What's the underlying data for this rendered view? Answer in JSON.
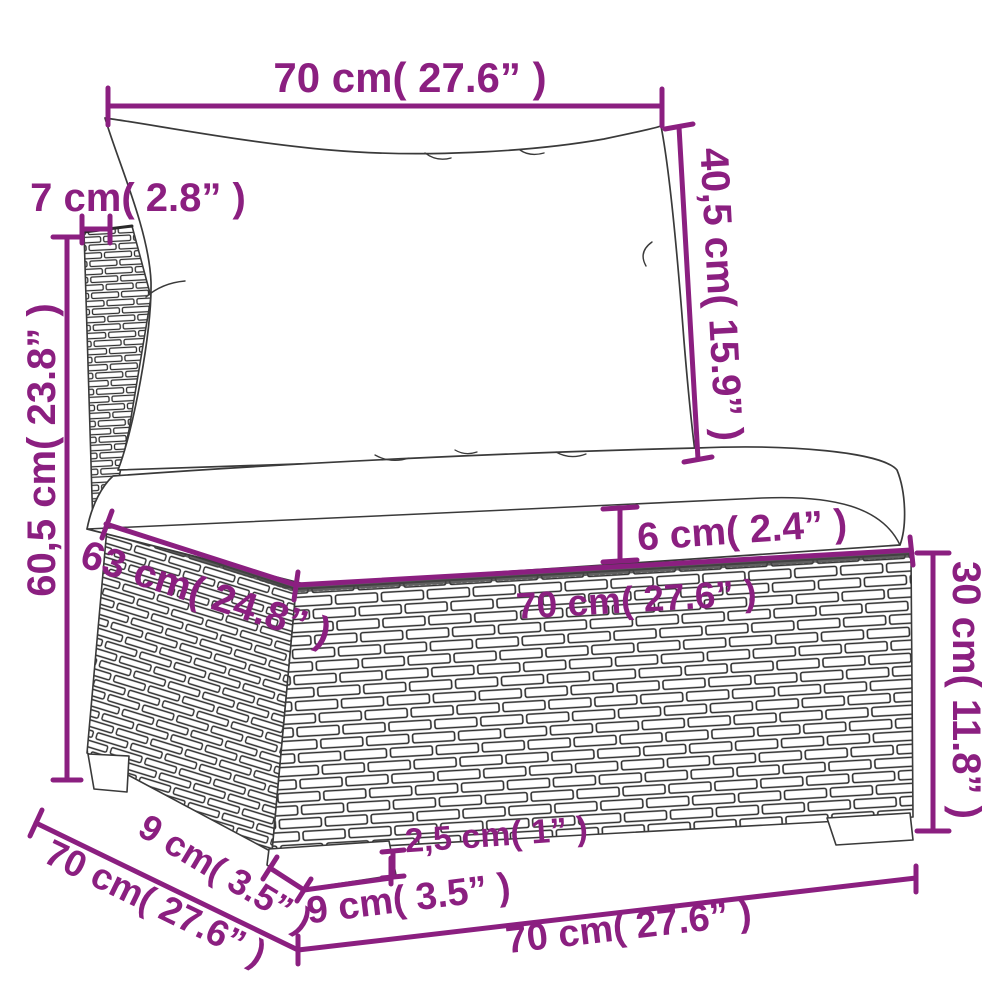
{
  "diagram": {
    "kind": "product-dimension-diagram",
    "colors": {
      "accent": "#8b1f80",
      "sketch": "#3a3a3a",
      "background": "#ffffff"
    },
    "dims": {
      "back_width": "70 cm( 27.6” )",
      "back_height": "40,5 cm( 15.9” )",
      "post_width": "7 cm( 2.8” )",
      "total_height": "60,5 cm( 23.8” )",
      "seat_depth": "63 cm( 24.8” )",
      "base_width": "70 cm( 27.6” )",
      "cushion_thickness": "6 cm( 2.4” )",
      "base_height": "30 cm( 11.8” )",
      "foot_height": "2,5 cm( 1” )",
      "foot_depth": "9 cm( 3.5” )",
      "foot_width": "9 cm( 3.5” )",
      "total_depth": "70 cm( 27.6” )",
      "total_width": "70 cm( 27.6” )"
    }
  }
}
